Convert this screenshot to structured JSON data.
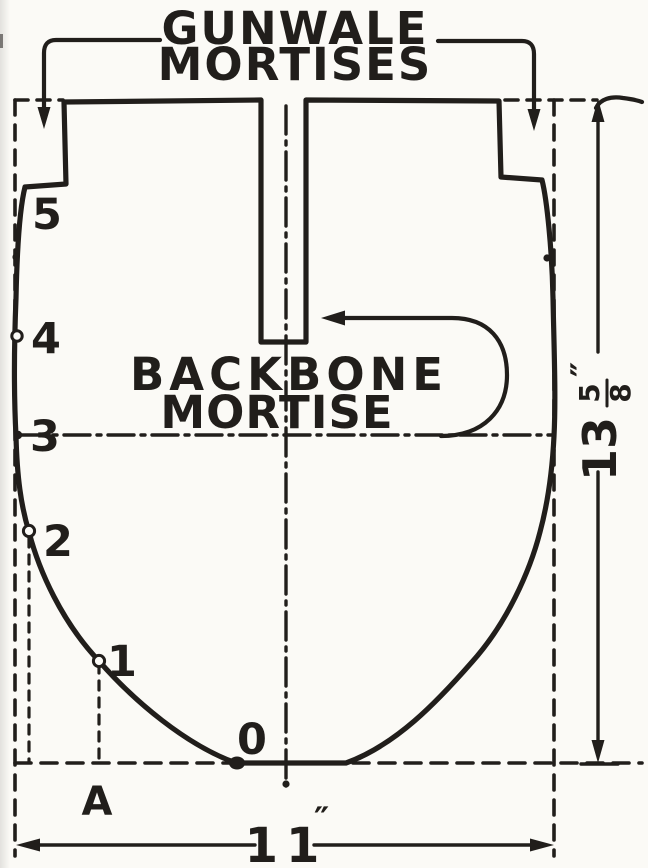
{
  "diagram_title": "Boat mold station template",
  "top_label": {
    "line1": "GUNWALE",
    "line2": "MORTISES"
  },
  "backbone_label": {
    "line1": "BACKBONE",
    "line2": "MORTISE"
  },
  "stations": {
    "s5": "5",
    "s4": "4",
    "s3": "3",
    "s2": "2",
    "s1": "1",
    "s0": "0"
  },
  "baseline_label": "A",
  "width_dim": {
    "value": "11",
    "unit": "″"
  },
  "height_dim": {
    "whole": "13",
    "numerator": "5",
    "denominator": "8",
    "unit": "″"
  },
  "colors": {
    "ink": "#211e1b",
    "paper": "#fbfaf6"
  }
}
